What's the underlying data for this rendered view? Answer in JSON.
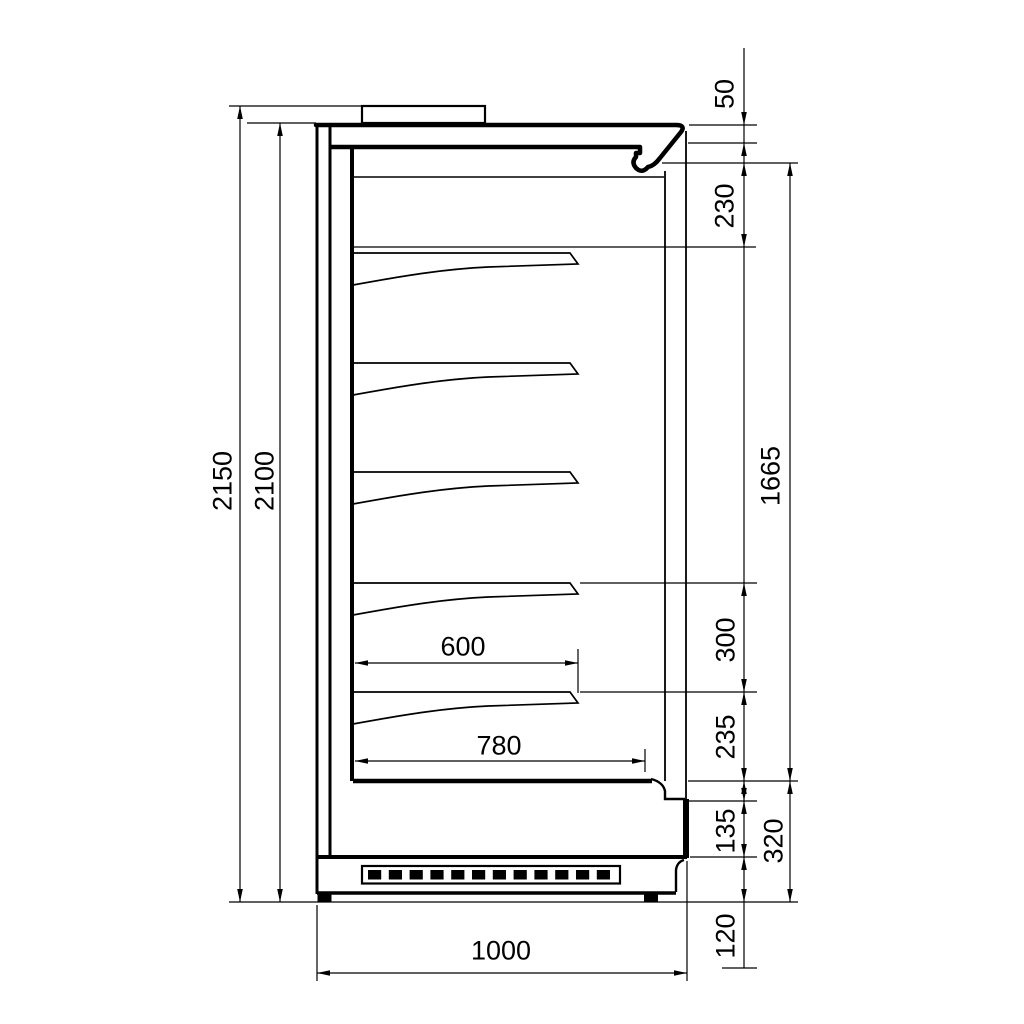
{
  "drawing": {
    "units": "mm",
    "colors": {
      "line": "#000000",
      "background": "#ffffff"
    },
    "dimensions": {
      "overall_height": "2150",
      "cabinet_height": "2100",
      "canopy_front_height": "50",
      "top_section_height": "230",
      "interior_front_height": "1665",
      "shelf_spacing": "300",
      "bottom_shelf_to_deck": "235",
      "lower_panel_height": "135",
      "base_section_height": "320",
      "plinth_height": "120",
      "shelf_depth": "600",
      "well_depth": "780",
      "overall_depth": "1000"
    }
  }
}
